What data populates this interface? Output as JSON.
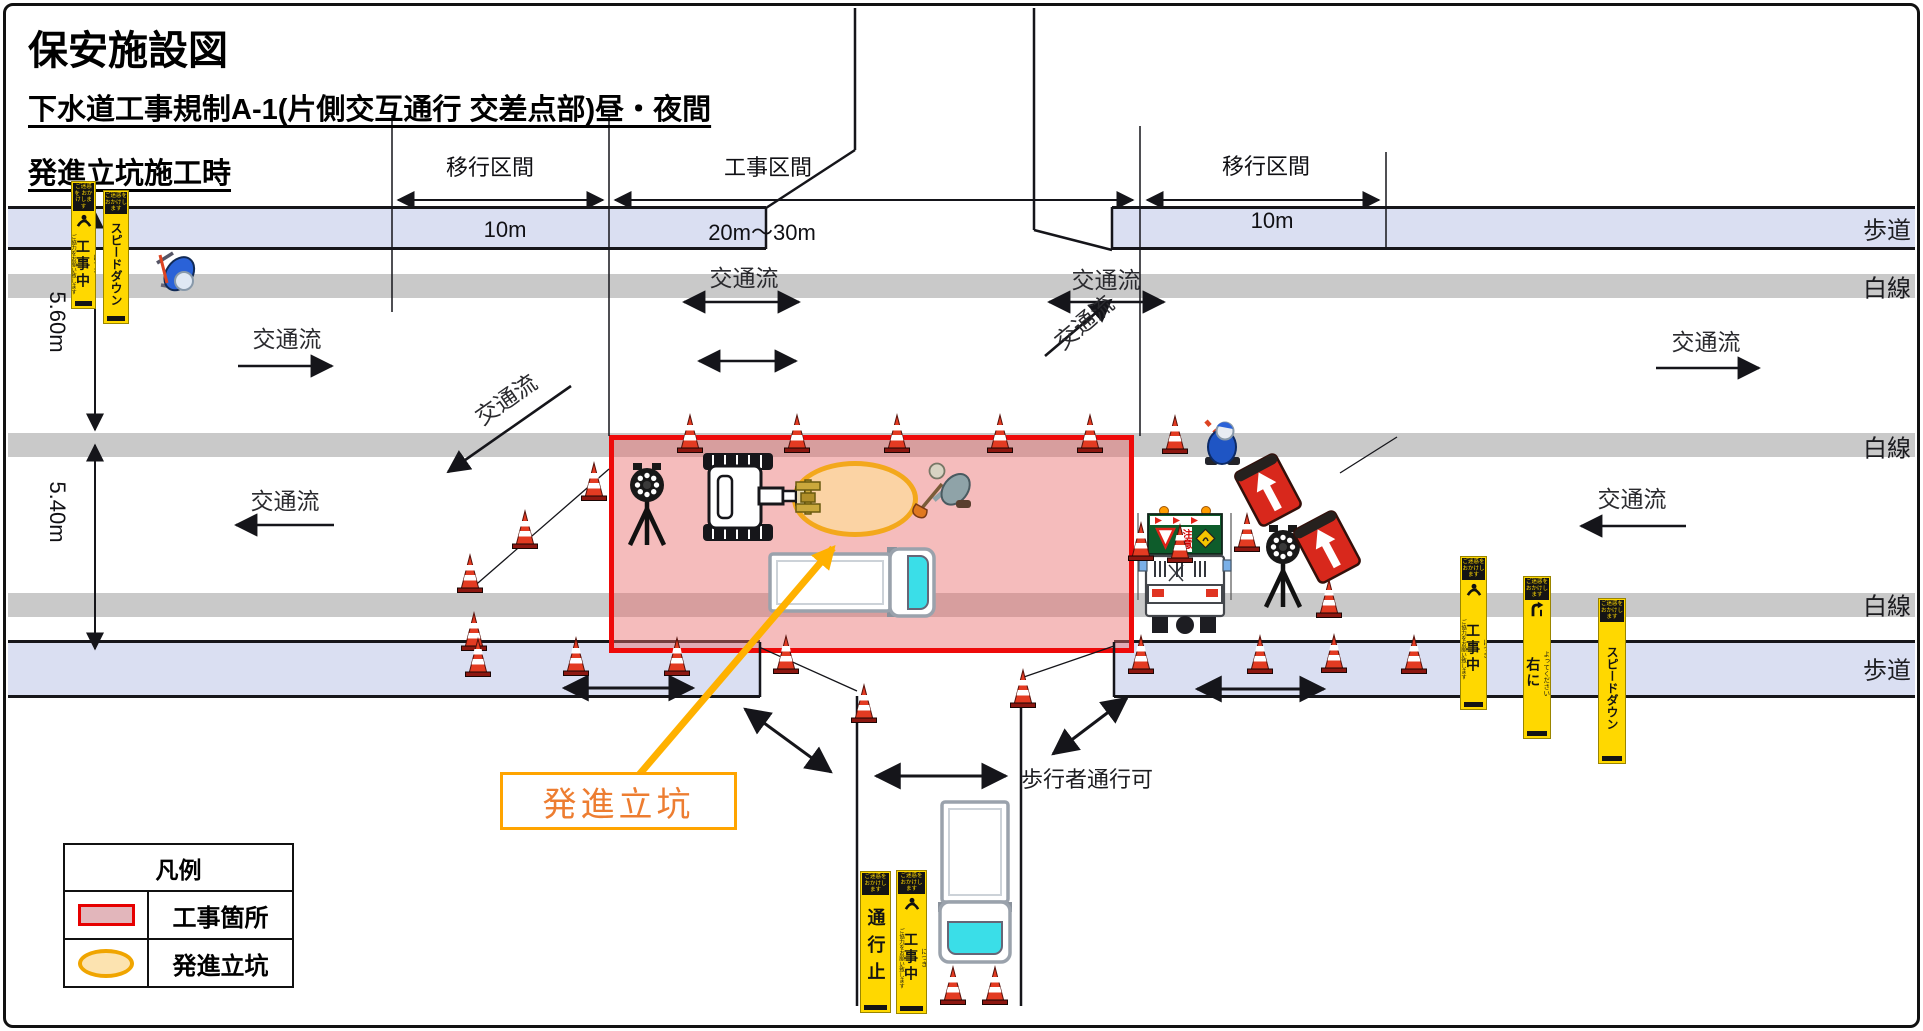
{
  "header": {
    "title": "保安施設図",
    "subtitle_line1": "下水道工事規制A-1(片側交互通行 交差点部)昼・夜間",
    "subtitle_line2": "発進立坑施工時"
  },
  "dimensions_top": [
    {
      "label": "移行区間",
      "value": "10m",
      "x1": 392,
      "x2": 609,
      "y": 200,
      "label_cx": 490,
      "label_cy": 166,
      "value_cx": 505,
      "value_cy": 230
    },
    {
      "label": "工事区間",
      "value": "20m〜30m",
      "x1": 609,
      "x2": 1140,
      "y": 200,
      "label_cx": 768,
      "label_cy": 166,
      "value_cx": 762,
      "value_cy": 231
    },
    {
      "label": "移行区間",
      "value": "10m",
      "x1": 1140,
      "x2": 1386,
      "y": 200,
      "label_cx": 1266,
      "label_cy": 165,
      "value_cx": 1272,
      "value_cy": 221
    }
  ],
  "dimensions_left": [
    {
      "label": "5.60m",
      "x": 95,
      "y1": 212,
      "y2": 430,
      "label_cx": 57,
      "label_cy": 322
    },
    {
      "label": "5.40m",
      "x": 95,
      "y1": 445,
      "y2": 649,
      "label_cx": 57,
      "label_cy": 512
    }
  ],
  "edge_labels": [
    {
      "text": "歩道",
      "y": 228
    },
    {
      "text": "白線",
      "y": 286
    },
    {
      "text": "白線",
      "y": 446
    },
    {
      "text": "白線",
      "y": 604
    },
    {
      "text": "歩道",
      "y": 668
    }
  ],
  "traffic_flows": [
    {
      "text": "交通流",
      "x": 287,
      "y": 337
    },
    {
      "text": "交通流",
      "x": 744,
      "y": 276
    },
    {
      "text": "交通流",
      "x": 1106,
      "y": 278
    },
    {
      "text": "交通流",
      "x": 1706,
      "y": 340
    },
    {
      "text": "交通流",
      "x": 285,
      "y": 499
    },
    {
      "text": "交通流",
      "x": 1632,
      "y": 497
    },
    {
      "text": "交通流",
      "x": 505,
      "y": 398,
      "rot": -35
    },
    {
      "text": "交通流",
      "x": 1083,
      "y": 321,
      "rot": -40
    }
  ],
  "callout": {
    "label": "発進立坑"
  },
  "pedestrian_note": "歩行者通行可",
  "legend": {
    "header": "凡例",
    "items": [
      {
        "label": "工事箇所",
        "swatch": "work-zone"
      },
      {
        "label": "発進立坑",
        "swatch": "launch-shaft"
      }
    ]
  },
  "sign_truck": {
    "caution_text": "注意"
  },
  "sign_types": {
    "koujichuu": {
      "header": "ご迷惑を おかけします",
      "main": "工事中",
      "sub": "につき",
      "note": "ご協力をお願い致します",
      "icon": "bow",
      "fs": 14,
      "ls": 3
    },
    "speeddown": {
      "header": "ご迷惑を おかけします",
      "main": "スピードダウン",
      "fs": 12,
      "ls": 0
    },
    "migi": {
      "header": "ご迷惑を おかけします",
      "main": "右に",
      "sub": "よってください",
      "icon": "curve",
      "fs": 14,
      "ls": 2
    },
    "tsuukoudome": {
      "header": "ご迷惑を おかけします",
      "main": "通行止",
      "fs": 18,
      "ls": 9
    }
  },
  "signs": [
    {
      "type": "koujichuu",
      "x": 71,
      "y": 181,
      "w": 25,
      "h": 128
    },
    {
      "type": "speeddown",
      "x": 103,
      "y": 190,
      "w": 26,
      "h": 134
    },
    {
      "type": "koujichuu",
      "x": 1460,
      "y": 556,
      "w": 27,
      "h": 154
    },
    {
      "type": "migi",
      "x": 1523,
      "y": 576,
      "w": 28,
      "h": 163
    },
    {
      "type": "speeddown",
      "x": 1598,
      "y": 598,
      "w": 28,
      "h": 166
    },
    {
      "type": "tsuukoudome",
      "x": 860,
      "y": 871,
      "w": 31,
      "h": 142
    },
    {
      "type": "koujichuu",
      "x": 896,
      "y": 870,
      "w": 31,
      "h": 144
    }
  ],
  "cones": [
    [
      690,
      452
    ],
    [
      797,
      452
    ],
    [
      897,
      452
    ],
    [
      1000,
      452
    ],
    [
      1090,
      452
    ],
    [
      594,
      500
    ],
    [
      525,
      548
    ],
    [
      470,
      592
    ],
    [
      474,
      650
    ],
    [
      478,
      676
    ],
    [
      576,
      675
    ],
    [
      677,
      675
    ],
    [
      786,
      673
    ],
    [
      864,
      722
    ],
    [
      1023,
      707
    ],
    [
      953,
      1004
    ],
    [
      995,
      1004
    ],
    [
      1175,
      453
    ],
    [
      1141,
      560
    ],
    [
      1180,
      562
    ],
    [
      1247,
      551
    ],
    [
      1329,
      617
    ],
    [
      1141,
      673
    ],
    [
      1260,
      673
    ],
    [
      1334,
      672
    ],
    [
      1414,
      673
    ]
  ],
  "arrows": [
    [
      398,
      200,
      603,
      200,
      "both",
      2
    ],
    [
      615,
      200,
      1133,
      200,
      "both",
      2
    ],
    [
      1147,
      200,
      1379,
      200,
      "both",
      2
    ],
    [
      95,
      212,
      95,
      430,
      "both",
      2
    ],
    [
      95,
      445,
      95,
      649,
      "both",
      2
    ],
    [
      238,
      366,
      332,
      366,
      "end",
      2.6
    ],
    [
      684,
      302,
      799,
      302,
      "both",
      2.6
    ],
    [
      699,
      361,
      796,
      361,
      "both",
      2.6
    ],
    [
      1049,
      302,
      1164,
      302,
      "both",
      2.6
    ],
    [
      1656,
      368,
      1759,
      368,
      "end",
      2.6
    ],
    [
      334,
      525,
      236,
      525,
      "end",
      2.6
    ],
    [
      1686,
      526,
      1581,
      526,
      "end",
      2.6
    ],
    [
      571,
      386,
      448,
      472,
      "end",
      2.6
    ],
    [
      1045,
      356,
      1111,
      300,
      "end",
      2.6
    ],
    [
      745,
      709,
      831,
      772,
      "both",
      3
    ],
    [
      1127,
      698,
      1053,
      754,
      "both",
      3
    ],
    [
      564,
      688,
      693,
      688,
      "both",
      3
    ],
    [
      1197,
      689,
      1324,
      689,
      "both",
      3
    ],
    [
      876,
      776,
      1006,
      776,
      "both",
      3
    ]
  ],
  "lines": [
    [
      392,
      115,
      392,
      312,
      1.5
    ],
    [
      609,
      115,
      609,
      436,
      1.5
    ],
    [
      1140,
      126,
      1140,
      436,
      1.5
    ],
    [
      1386,
      152,
      1386,
      248,
      1.5
    ],
    [
      855,
      8,
      855,
      150,
      2.5
    ],
    [
      766,
      208,
      855,
      150,
      2.5
    ],
    [
      1034,
      8,
      1034,
      230,
      2.5
    ],
    [
      1034,
      230,
      1112,
      250,
      2.5
    ],
    [
      766,
      207,
      766,
      249,
      2.5
    ],
    [
      1112,
      207,
      1112,
      249,
      2.5
    ],
    [
      857,
      696,
      857,
      1006,
      2.5
    ],
    [
      1021,
      696,
      1021,
      1006,
      2.5
    ],
    [
      760,
      642,
      760,
      697,
      2.5
    ],
    [
      1114,
      642,
      1114,
      697,
      2.5
    ],
    [
      759,
      647,
      857,
      691,
      1.3
    ],
    [
      1021,
      678,
      1114,
      646,
      1.3
    ],
    [
      609,
      469,
      471,
      589,
      1.3
    ],
    [
      1340,
      473,
      1397,
      437,
      1.3
    ]
  ],
  "colors": {
    "sidewalk": "#dadff2",
    "lane_line": "#c9c9c9",
    "work_zone_fill": "rgba(232,106,106,0.45)",
    "work_zone_border": "#ee0a0a",
    "shaft_fill": "#fbd3a4",
    "shaft_border": "#f3a81c",
    "callout_orange": "#ffa400",
    "callout_text": "#ed7d31",
    "sign_yellow": "#ffd800"
  }
}
